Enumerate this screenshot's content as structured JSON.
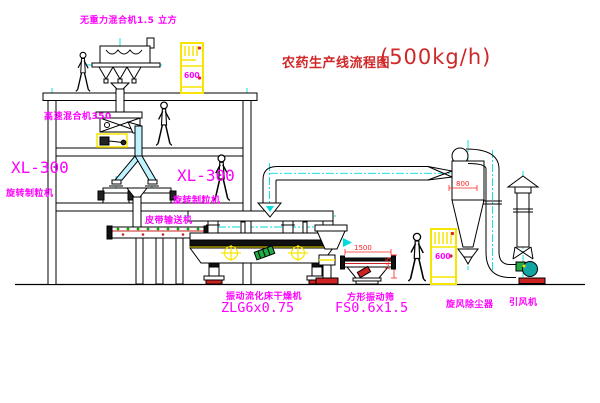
{
  "title": {
    "name": "农药生产线流程图",
    "capacity": "(500kg/h)"
  },
  "labels": {
    "gravity_mixer": "无重力混合机1.5 立方",
    "high_speed_mixer": "高速混合机350",
    "granulator_left_model": "XL-300",
    "granulator_left_name": "旋转制粒机",
    "granulator_right_model": "XL-300",
    "granulator_right_name": "旋转制粒机",
    "belt_conveyor": "皮带输送机",
    "dryer_name": "振动流化床干燥机",
    "dryer_model": "ZLG6x0.75",
    "sieve_name": "方形振动筛",
    "sieve_model": "FS0.6x1.5",
    "cyclone_name": "旋风除尘器",
    "fan_name": "引风机"
  },
  "dimensions": {
    "sieve_width": "1500",
    "sieve_height": "745",
    "cyclone_dia": "800",
    "cabinet1_mark": "600",
    "cabinet2_mark": "600"
  },
  "colors": {
    "line_black": "#000000",
    "label_magenta": "#ff00ff",
    "title_red": "#d02828",
    "dim_red": "#ff2020",
    "cabinet_yellow": "#f5e500",
    "centerline_cyan": "#00dcdc",
    "chute_fill": "#bff3ff",
    "motor_green": "#22aa44",
    "fan_teal": "#12a3a3",
    "base_red": "#cc2222"
  }
}
